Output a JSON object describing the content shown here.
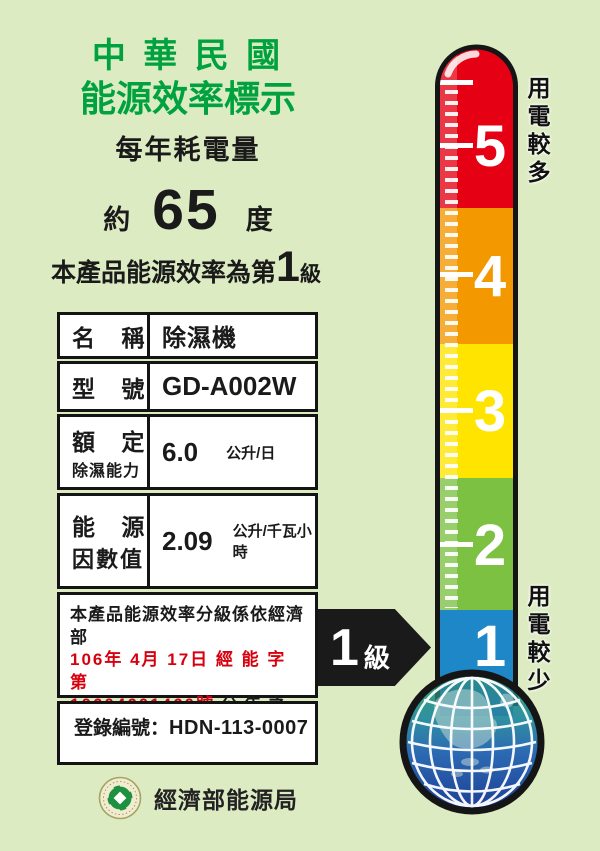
{
  "header": {
    "title_line1": "中 華 民 國",
    "title_line2": "能源效率標示",
    "annual_consumption_label": "每年耗電量"
  },
  "consumption": {
    "prefix": "約",
    "value": "65",
    "unit": "度"
  },
  "grade_statement": {
    "prefix": "本產品能源效率為第",
    "grade": "1",
    "suffix": "級"
  },
  "spec_table": {
    "rows": [
      {
        "label": "名 稱",
        "value": "除濕機",
        "unit": ""
      },
      {
        "label": "型 號",
        "value": "GD-A002W",
        "unit": ""
      },
      {
        "label_line1": "額 定",
        "label_line2": "除濕能力",
        "value": "6.0",
        "unit": "公升/日"
      },
      {
        "label_line1": "能 源",
        "label_line2": "因數值",
        "value": "2.09",
        "unit": "公升/千瓦小時"
      }
    ]
  },
  "note": {
    "line1": "本產品能源效率分級係依經濟部",
    "line2_red": "106年 4月 17日 經 能 字 第",
    "line3_red": "10604601460號",
    "line3_black": " 公 告 之",
    "line4": "能源效率分級基準表標示"
  },
  "registration": {
    "label": "登錄編號：",
    "value": "HDN-113-0007"
  },
  "footer": {
    "agency": "經濟部能源局"
  },
  "thermometer": {
    "top_caption": "用電較多",
    "bottom_caption": "用電較少",
    "levels": [
      {
        "label": "5",
        "color": "#e60013"
      },
      {
        "label": "4",
        "color": "#f49800"
      },
      {
        "label": "3",
        "color": "#ffe400"
      },
      {
        "label": "2",
        "color": "#7cc142"
      },
      {
        "label": "1",
        "color": "#1e87c8"
      }
    ]
  },
  "grade_arrow": {
    "grade": "1",
    "suffix": "級"
  },
  "colors": {
    "background": "#dcebc2",
    "title_green": "#00a23f",
    "note_red": "#d7000f",
    "arrow_black": "#1a1a1a"
  }
}
